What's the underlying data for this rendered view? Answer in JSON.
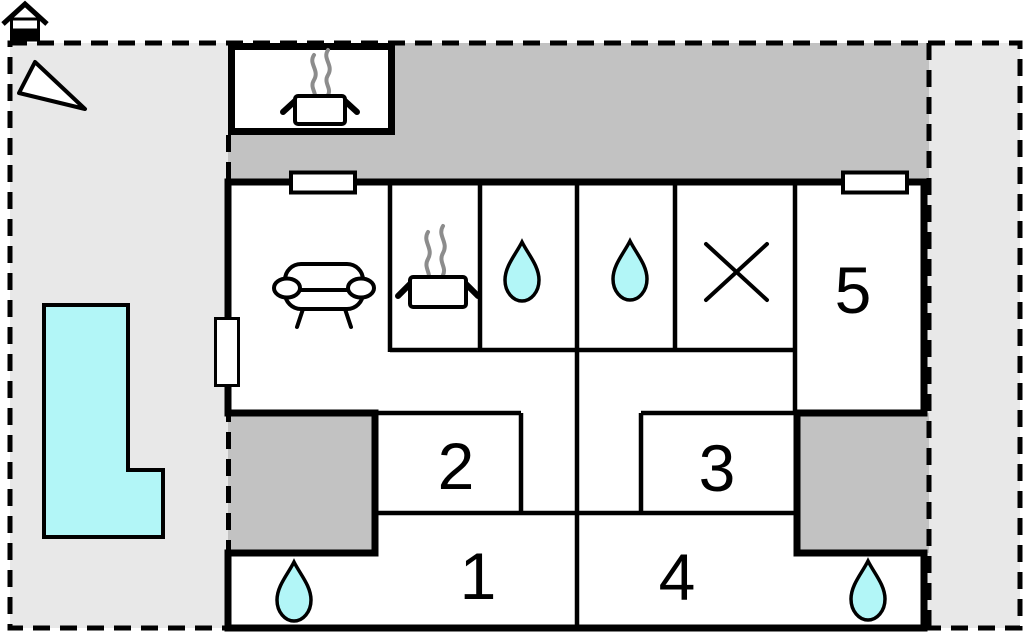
{
  "document": {
    "kind": "floor-plan",
    "description": "holiday home floor plan with terraces, pool and numbered rooms"
  },
  "colors": {
    "ground": "#e8e8e8",
    "terrace": "#c2c2c2",
    "water": "#b2f6f7",
    "wall": "#000000",
    "interior": "#ffffff",
    "steam": "#8c8c8c"
  },
  "rooms": [
    {
      "id": "room-1",
      "label": "1"
    },
    {
      "id": "room-2",
      "label": "2"
    },
    {
      "id": "room-3",
      "label": "3"
    },
    {
      "id": "room-4",
      "label": "4"
    },
    {
      "id": "room-5",
      "label": "5"
    }
  ],
  "icons": [
    "house-icon",
    "north-arrow-icon",
    "pool",
    "bbq-hut",
    "cooking-pot-icon",
    "steam-icon",
    "sofa-icon",
    "water-drop-icon",
    "x-mark-icon",
    "window",
    "door"
  ]
}
